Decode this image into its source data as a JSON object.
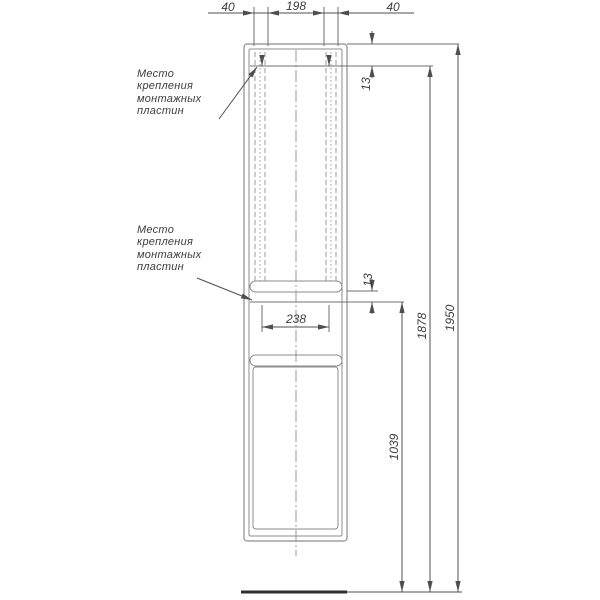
{
  "drawing": {
    "notes": {
      "note1": {
        "lines": [
          "Место",
          "крепления",
          "монтажных",
          "пластин"
        ]
      },
      "note2": {
        "lines": [
          "Место",
          "крепления",
          "монтажных",
          "пластин"
        ]
      }
    },
    "dimensions": {
      "top_left": "40",
      "top_center": "198",
      "top_right": "40",
      "plate_offset_top": "13",
      "plate_offset_middle": "13",
      "plate_span_lower": "238",
      "height_lower_plate": "1039",
      "height_upper_plate": "1878",
      "height_total": "1950"
    },
    "colors": {
      "background": "#ffffff",
      "outline": "#8d8d8d",
      "hidden_lines": "#9a9a9a",
      "reference_lines": "#6f6f6f",
      "dimension_lines": "#4f4f4f",
      "text": "#3d3d3d",
      "ground": "#2f2f2f"
    }
  }
}
